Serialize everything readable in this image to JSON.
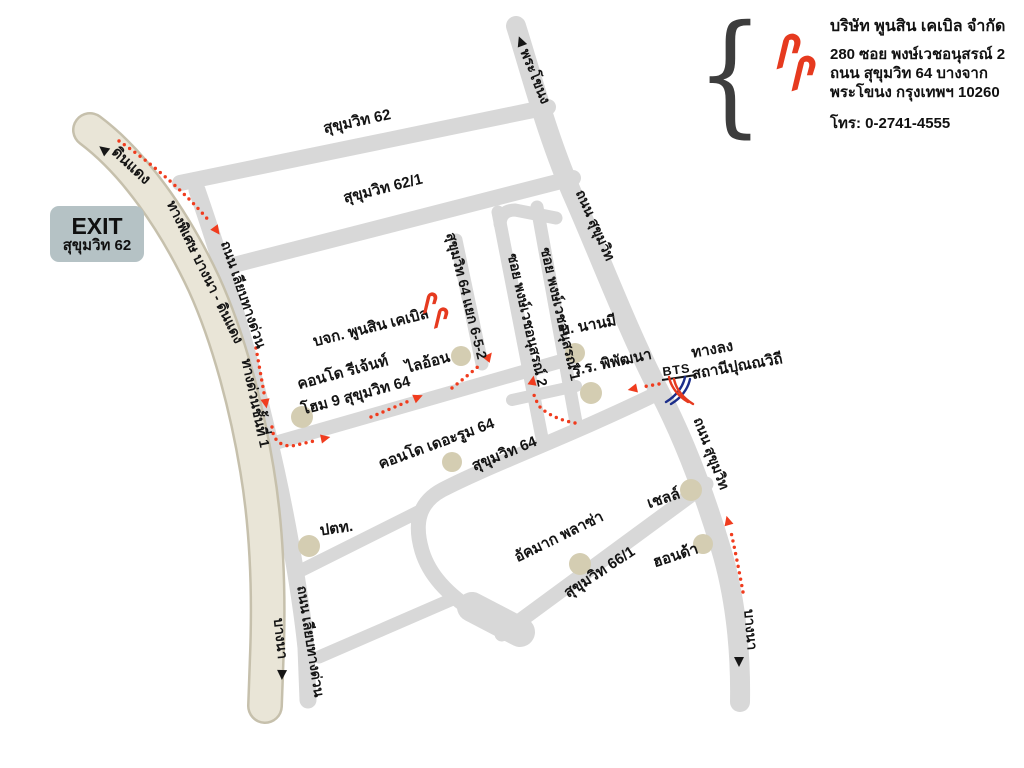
{
  "info_panel": {
    "company_title": "บริษัท พูนสิน เคเบิล จำกัด",
    "address_line1": "280 ซอย พงษ์เวชอนุสรณ์ 2",
    "address_line2": "ถนน สุขุมวิท 64 บางจาก",
    "address_line3": "พระโขนง กรุงเทพฯ 10260",
    "phone": "โทร: 0-2741-4555",
    "brace_left": "{",
    "brace_right": "}"
  },
  "exit_badge": {
    "line1": "EXIT",
    "line2": "สุขุมวิท 62"
  },
  "map": {
    "colors": {
      "road": "#d8d8d8",
      "expressway_fill": "#e9e5d7",
      "expressway_edge": "#c6c0ac",
      "poi_marker": "#d4cdb2",
      "route": "#f03c1e",
      "logo_red": "#e63a1f",
      "bts_blue": "#1c2e8b",
      "label": "#141414"
    },
    "road_labels": [
      {
        "text": "สุขุมวิท 62"
      },
      {
        "text": "สุขุมวิท 62/1"
      },
      {
        "text": "พระโขนง"
      },
      {
        "text": "ถนน สุขุมวิท"
      },
      {
        "text": "ถนน สุขุมวิท"
      },
      {
        "text": "บางนา"
      },
      {
        "text": "ดินแดง"
      },
      {
        "text": "ทางพิเศษ บางนา - ดินแดง"
      },
      {
        "text": "ทางด่วนชั้นที่ 1"
      },
      {
        "text": "บางนา"
      },
      {
        "text": "ถนน เลียบทางด่วน"
      },
      {
        "text": "ถนน เลียบทางด่วน"
      },
      {
        "text": "สุขุมวิท 64 แยก 6-5-2"
      },
      {
        "text": "ซอย พงษ์เวชอนุสรณ์ 2"
      },
      {
        "text": "ซอย พงษ์เวชอนุสรณ์ 1"
      },
      {
        "text": "สุขุมวิท 64"
      },
      {
        "text": "สุขุมวิท 66/1"
      }
    ],
    "place_labels": [
      {
        "text": "บจก. พูนสิน เคเบิล"
      },
      {
        "text": "คอนโด รีเจ้นท์"
      },
      {
        "text": "โฮม 9 สุขุมวิท 64"
      },
      {
        "text": "ไลอ้อน"
      },
      {
        "text": "บ. นานมี"
      },
      {
        "text": "ร.ร. พิพัฒนา"
      },
      {
        "text": "คอนโด เดอะรูม 64"
      },
      {
        "text": "ปตท."
      },
      {
        "text": "อัคมาก พลาซ่า"
      },
      {
        "text": "เชลล์"
      },
      {
        "text": "ฮอนด้า"
      }
    ],
    "bts": {
      "label": "BTS",
      "exit_line1": "ทางลง",
      "exit_line2": "สถานีปุณณวิถี"
    }
  }
}
